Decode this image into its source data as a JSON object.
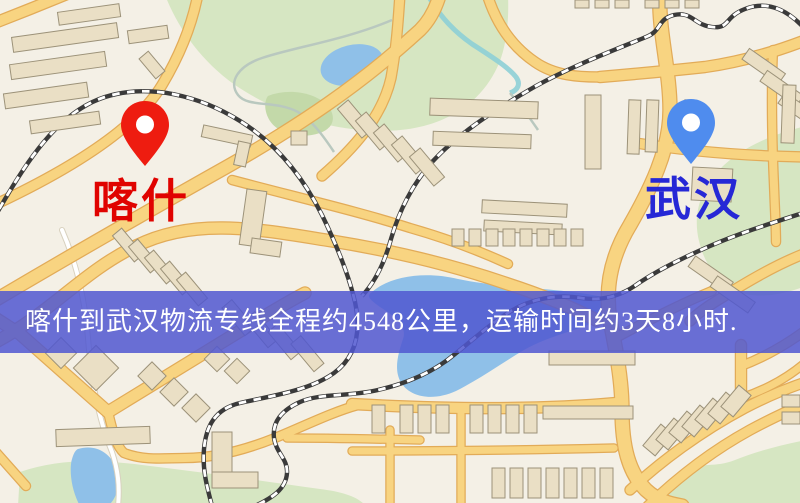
{
  "map": {
    "type": "street-map",
    "palette": {
      "background": "#f4f0e6",
      "road_fill": "#f8d481",
      "road_casing": "#e2ab58",
      "minor_road": "#ffffff",
      "building": "#eadfc5",
      "green_area": "#d6e6c2",
      "water": "#8fc0e8",
      "railway": "#3a3a3a"
    }
  },
  "markers": {
    "origin": {
      "name": "喀什",
      "pin_color": "#ee1c10",
      "label_color": "#e00300"
    },
    "destination": {
      "name": "武汉",
      "pin_color": "#4f8cee",
      "label_color": "#2628d6"
    }
  },
  "banner": {
    "text": "喀什到武汉物流专线全程约4548公里，运输时间约3天8小时.",
    "background_color": "#5057d0",
    "text_color": "#ffffff"
  }
}
